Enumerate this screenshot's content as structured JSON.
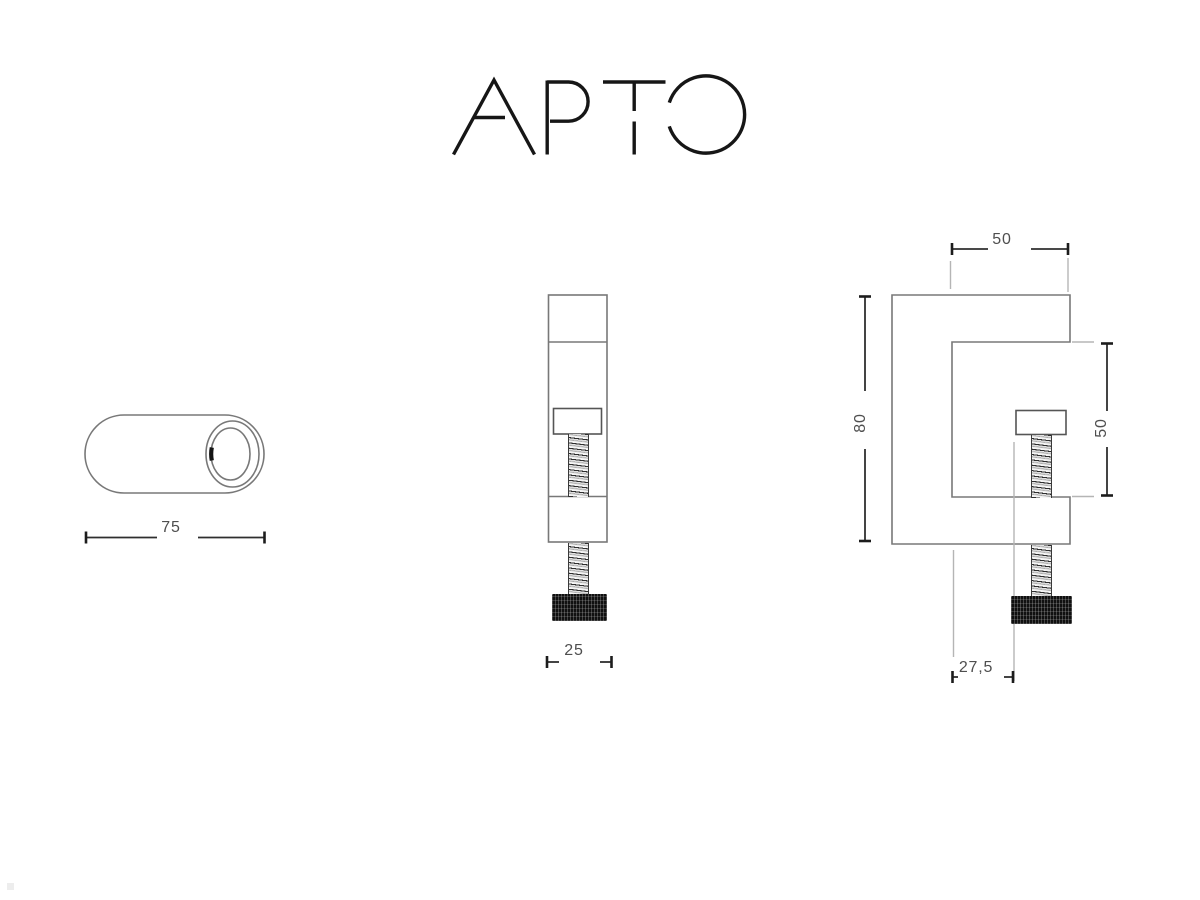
{
  "logo": {
    "text": "APTO"
  },
  "drawing": {
    "title": "APTO table clamp technical drawing",
    "dimensions": {
      "cylinder_length": "75",
      "body_width": "25",
      "top_depth": "50",
      "jaw_height": "50",
      "total_height": "80",
      "throat_offset": "27,5"
    },
    "colors": {
      "object_line": "#787878",
      "dimension_line": "#2f2f2f",
      "extension_line": "#b5b5b5",
      "label_text": "#4f4f4f",
      "knob_fill": "#101010",
      "logo_stroke": "#161616"
    }
  }
}
